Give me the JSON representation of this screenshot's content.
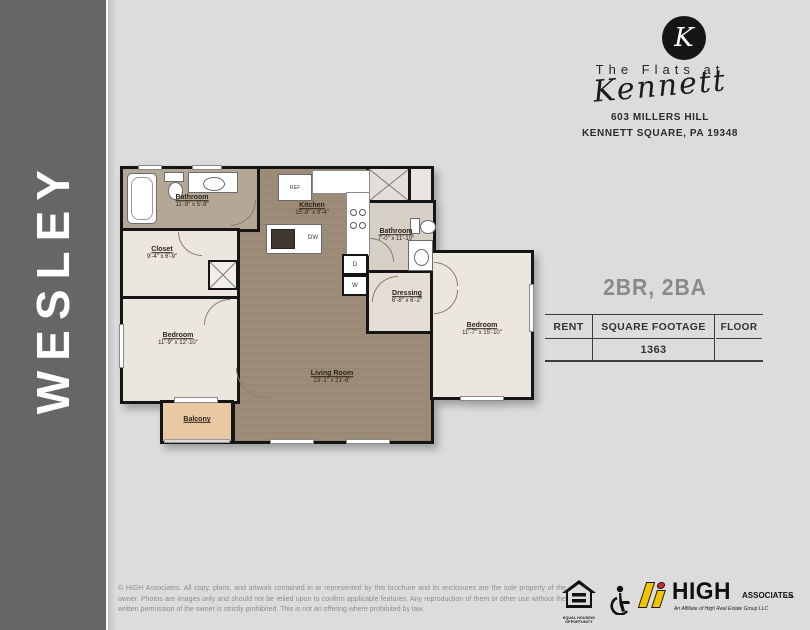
{
  "sidebar": {
    "plan_name": "WESLEY"
  },
  "brand": {
    "monogram": "K",
    "line1": "The Flats at",
    "script": "Kennett",
    "address1": "603 MILLERS HILL",
    "address2": "KENNETT SQUARE, PA 19348"
  },
  "details": {
    "config": "2BR, 2BA",
    "col_rent": "RENT",
    "col_sqft": "SQUARE FOOTAGE",
    "col_floor": "FLOOR",
    "rent_value": "",
    "sqft_value": "1363",
    "floor_value": ""
  },
  "floorplan": {
    "rooms": {
      "bathroom1": {
        "name": "Bathroom",
        "dims": "11'-9\" x 5'-8\""
      },
      "closet": {
        "name": "Closet",
        "dims": "9'-4\" x 6'-9\""
      },
      "bedroom1": {
        "name": "Bedroom",
        "dims": "11'-9\" x 12'-10\""
      },
      "balcony": {
        "name": "Balcony",
        "dims": ""
      },
      "kitchen": {
        "name": "Kitchen",
        "dims": "15'-8\" x 9'-4\""
      },
      "living": {
        "name": "Living Room",
        "dims": "23'-1\" x 21'-6\""
      },
      "bathroom2": {
        "name": "Bathroom",
        "dims": "7'-0\" x 11'-10\""
      },
      "dressing": {
        "name": "Dressing",
        "dims": "6'-8\" x 6'-2\""
      },
      "bedroom2": {
        "name": "Bedroom",
        "dims": "11'-7\" x 15'-10\""
      }
    },
    "appliances": {
      "ref": "REF",
      "dw": "DW",
      "dryer": "D",
      "washer": "W"
    }
  },
  "footer": {
    "disclaimer": "© HIGH Associates. All copy, plans, and artwork contained in or represented by this brochure and its enclosures are the sole property of the owner. Photos are images only and should not be relied upon to confirm applicable features. Any reproduction of them or other use without the written permission of the owner is strictly prohibited. This is not an offering where prohibited by law.",
    "equal_housing": "EQUAL HOUSING OPPORTUNITY",
    "high": {
      "word": "HIGH",
      "associates": "ASSOCIATES",
      "ltd": "LTD.",
      "tagline": "An Affiliate of High Real Estate Group LLC"
    }
  },
  "colors": {
    "sidebar": "#666664",
    "background": "#dcdcdc",
    "floor_wood": "#9c8c77",
    "floor_cream": "#ece7de",
    "balcony_tan": "#e9c8a4",
    "wall": "#151515",
    "high_yellow": "#f2c300",
    "high_red": "#cf2a27"
  }
}
